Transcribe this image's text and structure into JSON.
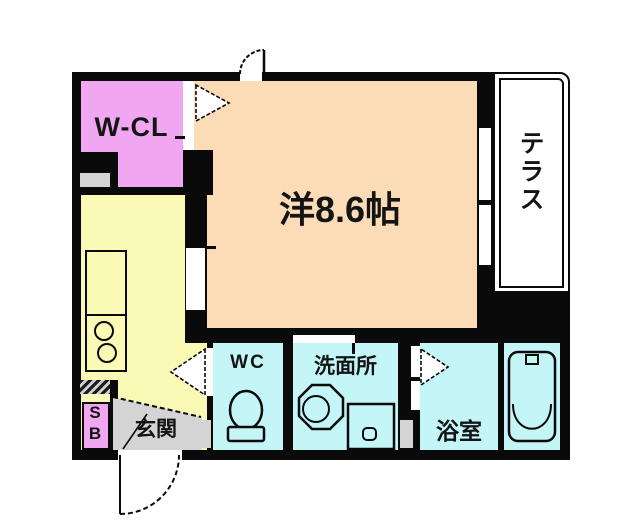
{
  "floorplan": {
    "title": "1K apartment floor plan",
    "rooms": {
      "walk_in_closet": {
        "label": "W-CL"
      },
      "main_room": {
        "label": "洋8.6帖"
      },
      "terrace": {
        "label": "テラス"
      },
      "toilet": {
        "label": "WC"
      },
      "washroom": {
        "label": "洗面所"
      },
      "bathroom": {
        "label": "浴室"
      },
      "entrance": {
        "label": "玄関"
      },
      "shoe_box": {
        "label_top": "S",
        "label_bottom": "B"
      }
    },
    "colors": {
      "wall": "#0a0a0a",
      "walk_in_closet": "#f0a6f0",
      "main_room": "#fcdcb6",
      "kitchen": "#fafab6",
      "wet_rooms": "#c4f6f8",
      "entrance_floor": "#d4d4d4",
      "shoe_box": "#f0a6f0",
      "terrace": "#ffffff"
    },
    "icons": [
      "kitchen-counter-icon",
      "stove-burners-icon",
      "toilet-icon",
      "sink-icon",
      "washing-machine-icon",
      "bathtub-icon",
      "door-swing-arc-icon",
      "door-triangle-icon"
    ]
  }
}
